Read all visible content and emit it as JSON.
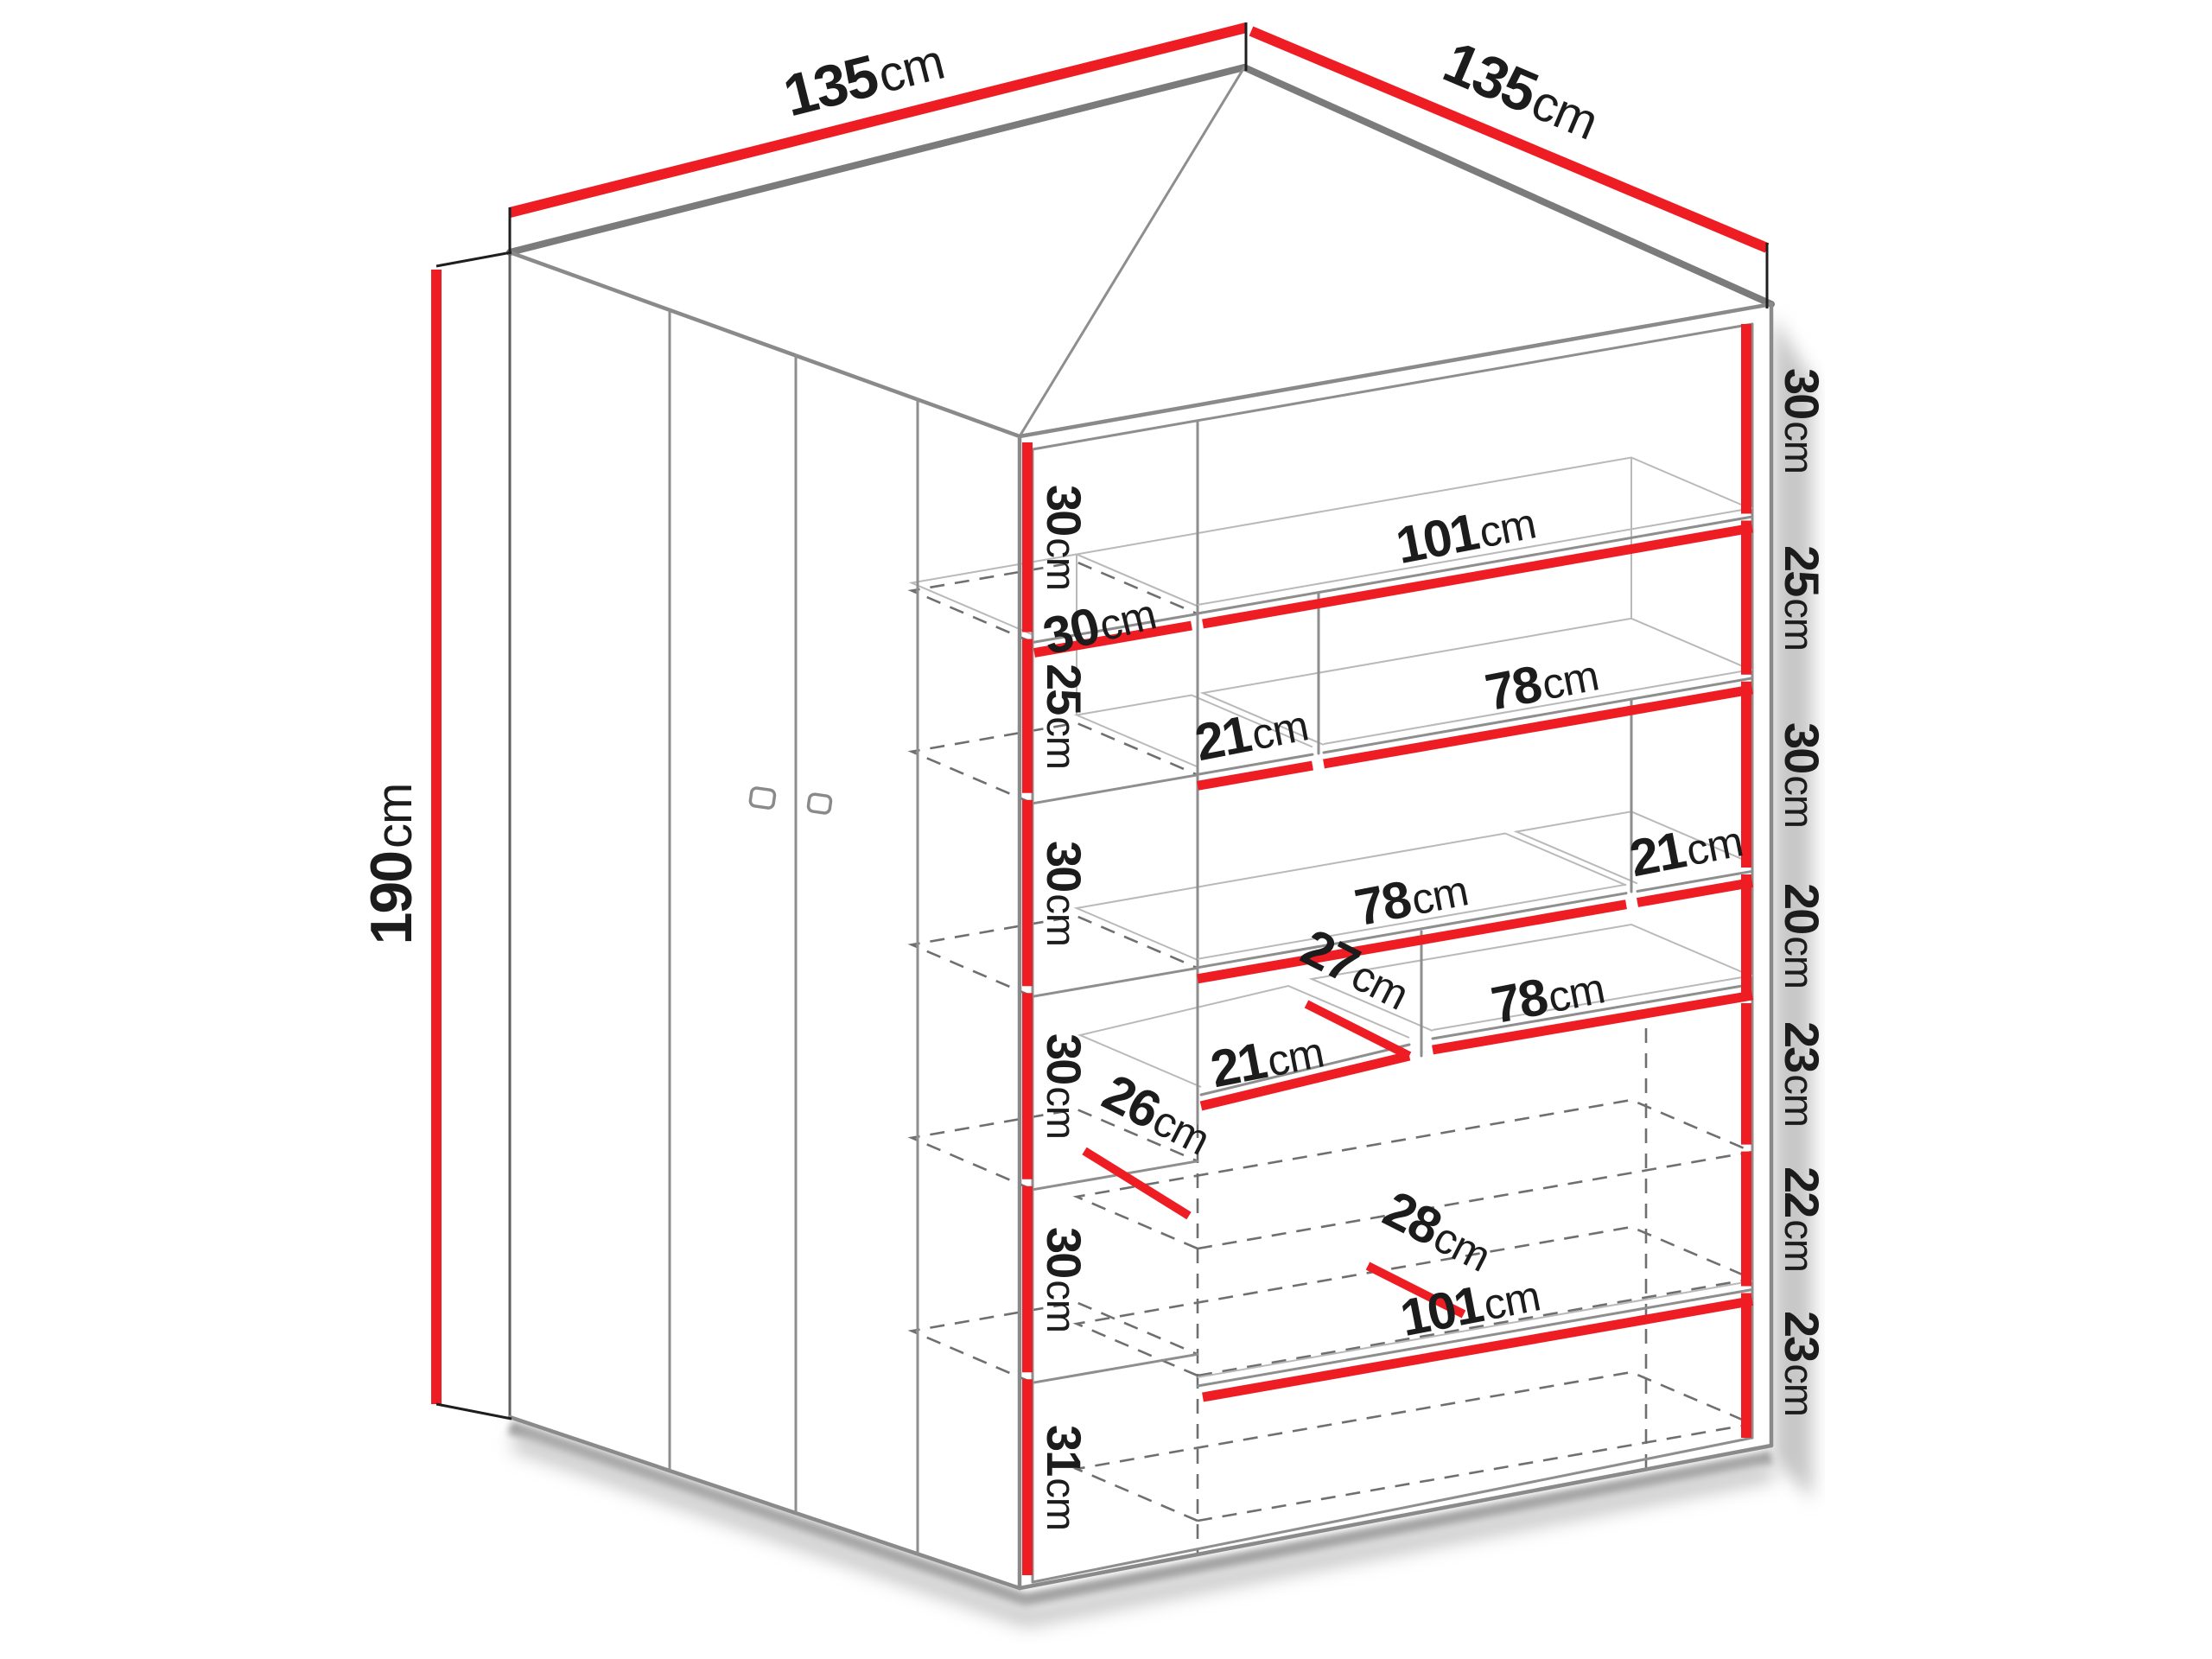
{
  "diagram": {
    "object": "corner-wardrobe-dimension-diagram",
    "unit": "cm"
  },
  "colors": {
    "dimension_red": "#ee1c23",
    "label_ink": "#1c1c1c",
    "edge_gray": "#7b7b7b",
    "shadow_gray": "#bdbdbd"
  },
  "outer_dimensions": {
    "top_left_width": {
      "num": "135",
      "unit": "cm"
    },
    "top_right_depth": {
      "num": "135",
      "unit": "cm"
    },
    "left_height": {
      "num": "190",
      "unit": "cm"
    }
  },
  "left_column_heights": [
    {
      "num": "30",
      "unit": "cm"
    },
    {
      "num": "25",
      "unit": "cm"
    },
    {
      "num": "30",
      "unit": "cm"
    },
    {
      "num": "30",
      "unit": "cm"
    },
    {
      "num": "30",
      "unit": "cm"
    },
    {
      "num": "31",
      "unit": "cm"
    }
  ],
  "right_side_heights": [
    {
      "num": "30",
      "unit": "cm"
    },
    {
      "num": "25",
      "unit": "cm"
    },
    {
      "num": "30",
      "unit": "cm"
    },
    {
      "num": "20",
      "unit": "cm"
    },
    {
      "num": "23",
      "unit": "cm"
    },
    {
      "num": "22",
      "unit": "cm"
    },
    {
      "num": "23",
      "unit": "cm"
    }
  ],
  "interior_widths": {
    "column_shelf": {
      "num": "30",
      "unit": "cm"
    },
    "top_shelf": {
      "num": "101",
      "unit": "cm"
    },
    "row2_left": {
      "num": "21",
      "unit": "cm"
    },
    "row2_right": {
      "num": "78",
      "unit": "cm"
    },
    "row3_left": {
      "num": "78",
      "unit": "cm"
    },
    "row3_right": {
      "num": "21",
      "unit": "cm"
    },
    "row4_left": {
      "num": "21",
      "unit": "cm"
    },
    "row4_right": {
      "num": "78",
      "unit": "cm"
    },
    "bottom_shelf": {
      "num": "101",
      "unit": "cm"
    }
  },
  "depth_annotations": {
    "row4_divider": {
      "num": "27",
      "unit": "cm"
    },
    "left_shelf": {
      "num": "26",
      "unit": "cm"
    },
    "drawer": {
      "num": "28",
      "unit": "cm"
    }
  }
}
